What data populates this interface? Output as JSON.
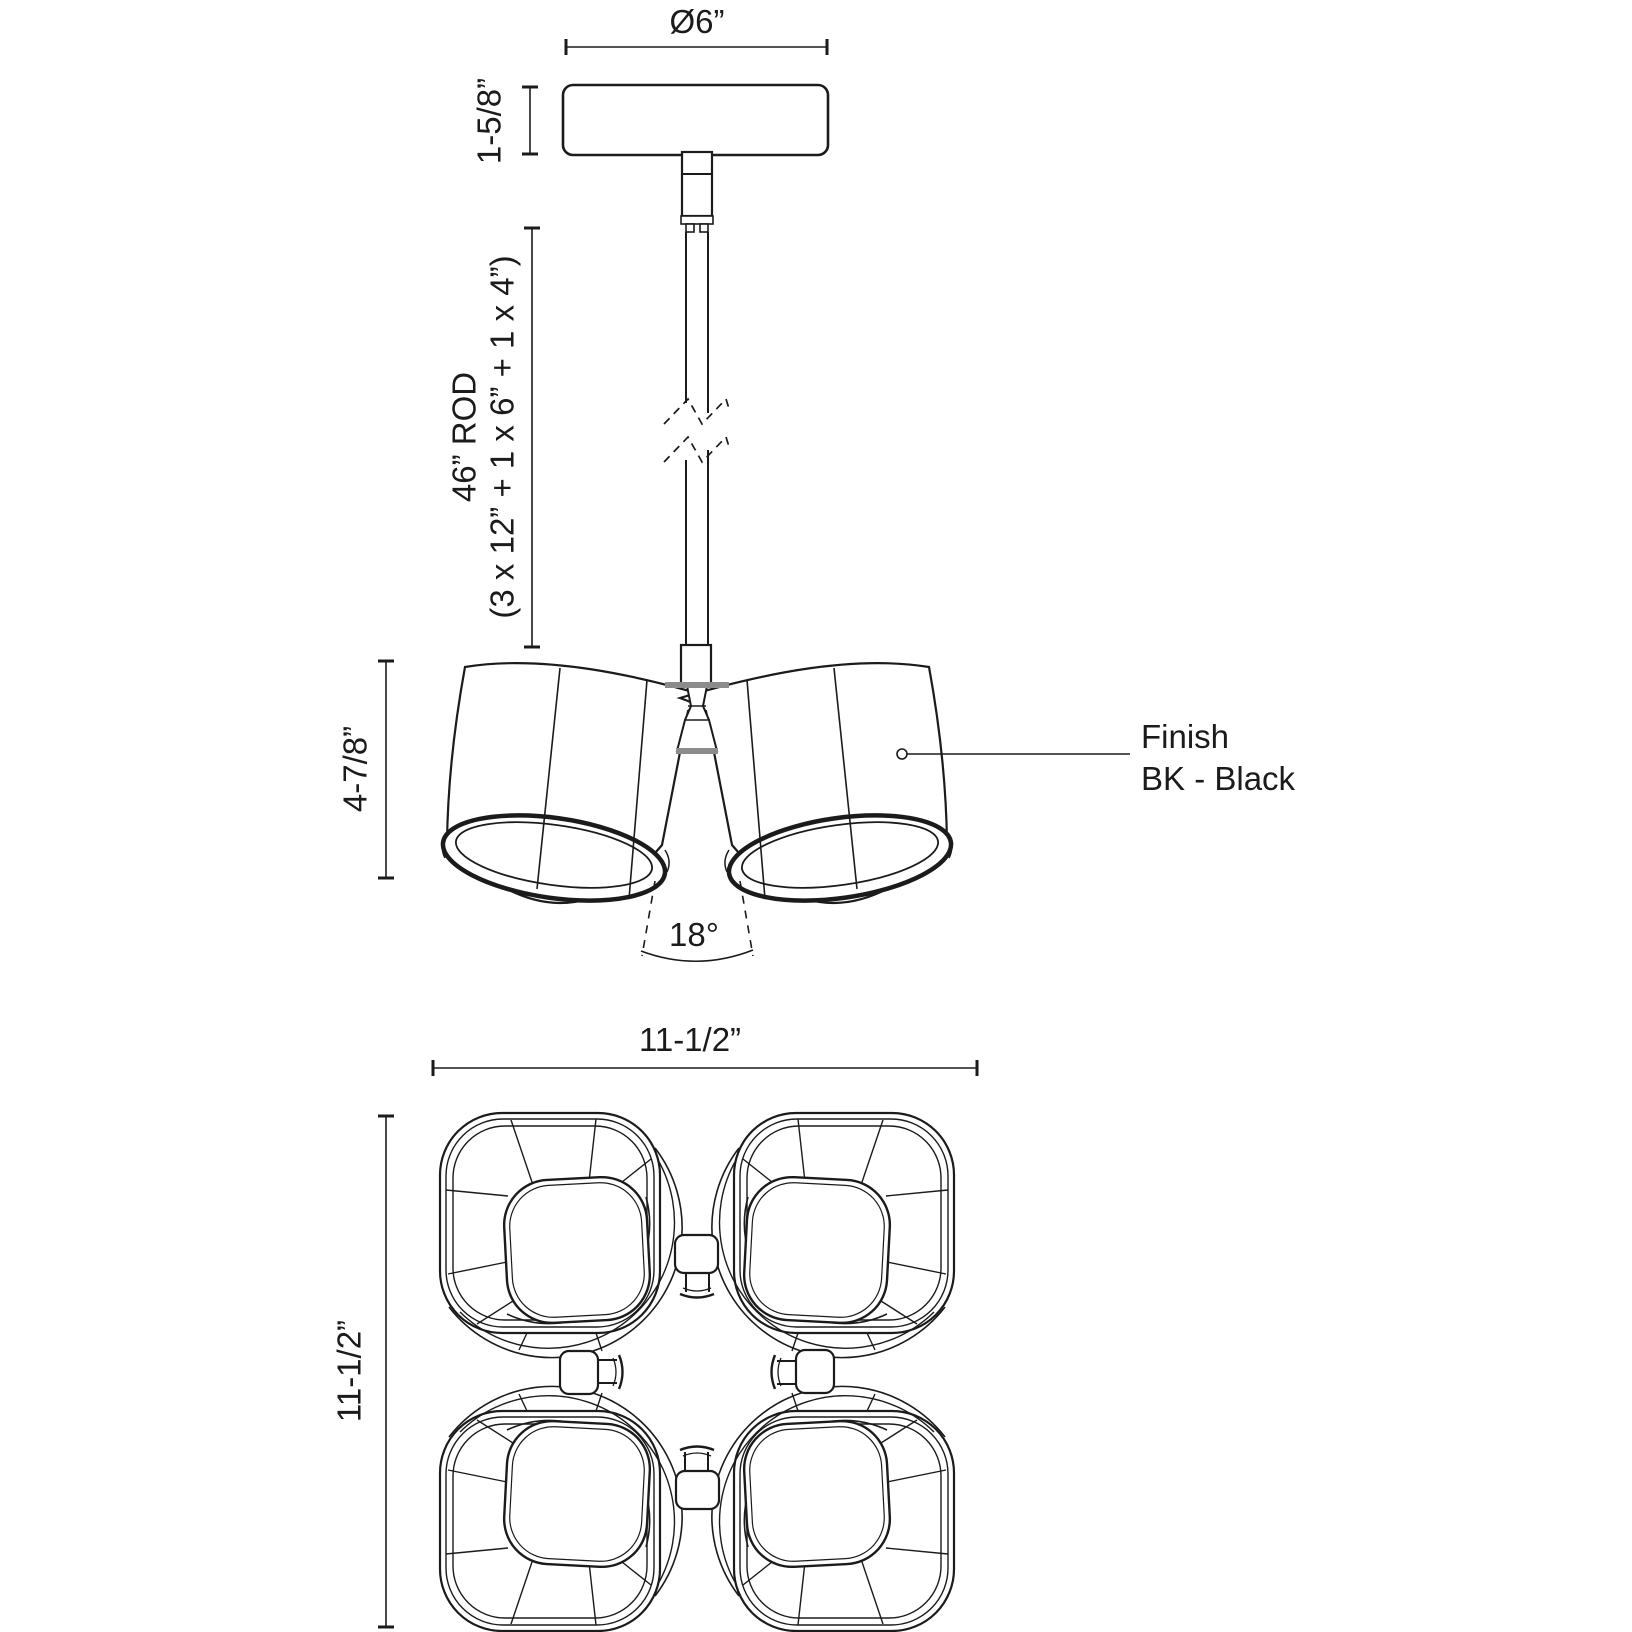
{
  "drawing": {
    "type": "luminaire-dimension-diagram",
    "front_view": {
      "canopy_diameter": "Ø6”",
      "canopy_height": "1-5/8”",
      "rod_length_line1": "46” ROD",
      "rod_length_line2": "(3 x 12” + 1 x 6” + 1 x 4”)",
      "shade_assembly_height": "4-7/8”",
      "beam_angle": "18°",
      "finish": {
        "line1": "Finish",
        "line2": "BK - Black"
      }
    },
    "plan_view": {
      "width": "11-1/2”",
      "depth": "11-1/2”"
    },
    "colors": {
      "line": "#1b1b1b",
      "hub_gray": "#8c8c8c",
      "background": "#ffffff"
    }
  }
}
